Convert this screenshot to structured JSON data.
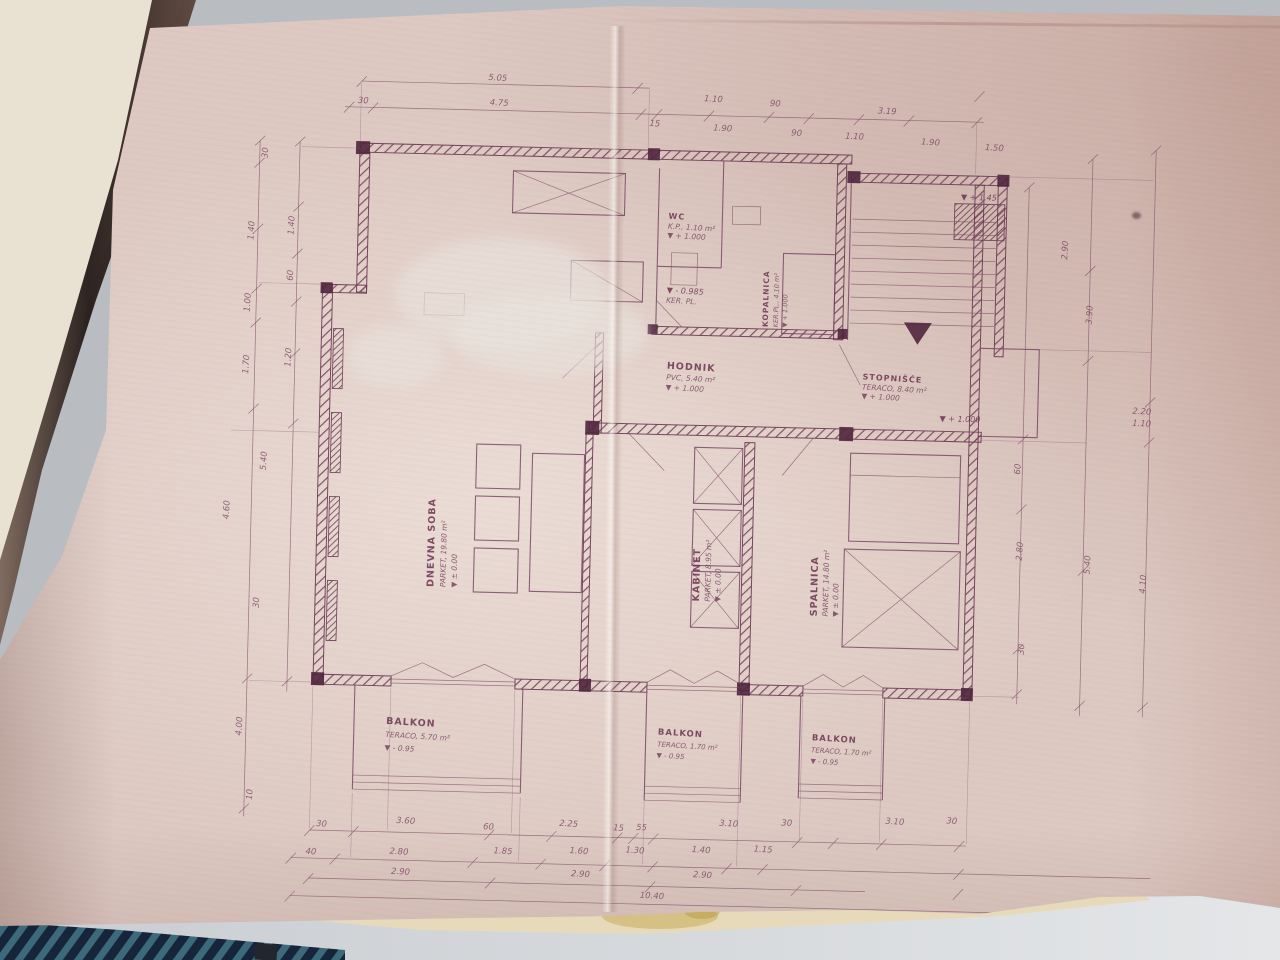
{
  "palette": {
    "paper_pink": "#ddc9c2",
    "ink_maroon": "#6b3350",
    "cover_brown": "#2e211f",
    "fabric_navy": "#1d2f42",
    "table_grey": "#d4d7da",
    "under_sheet_cream": "#e7dabb",
    "stain_yellow": "#c9b05e"
  },
  "plan": {
    "rooms": [
      {
        "name": "DNEVNA SOBA",
        "finish": "PARKET, 19.80 m²",
        "level": "▼ ± 0.00"
      },
      {
        "name": "KABINET",
        "finish": "PARKET, 8.95 m²",
        "level": "▼ ± 0.00"
      },
      {
        "name": "SPALNICA",
        "finish": "PARKET, 14.80 m²",
        "level": "▼ ± 0.00"
      },
      {
        "name": "HODNIK",
        "finish": "PVC, 5.40 m²",
        "level": "▼ + 1.000"
      },
      {
        "name": "STOPNIŠĆE",
        "finish": "TERACO, 8.40 m²",
        "level": "▼ + 1.000"
      },
      {
        "name": "WC",
        "finish": "K.P., 1.10 m²",
        "level": "▼ + 1.000"
      },
      {
        "name": "KOPALNICA",
        "finish": "KER.PL., 4.10 m²",
        "level": "▼ + 1.000"
      },
      {
        "name": "BALKON",
        "finish": "TERACO, 5.70 m²",
        "level": "▼ - 0.95"
      },
      {
        "name": "BALKON",
        "finish": "TERACO, 1.70 m²",
        "level": "▼ - 0.95"
      },
      {
        "name": "BALKON",
        "finish": "TERACO, 1.70 m²",
        "level": "▼ - 0.95"
      }
    ],
    "levels": {
      "stair_upper": "▼ + 1.45",
      "stair_mid": "▼ + 1.000",
      "wc_lower": "▼ - 0.985",
      "wc_lower_finish": "KER. PL."
    },
    "dimensions": [
      {
        "t": "5.05",
        "x": 488,
        "y": 84
      },
      {
        "t": "30",
        "x": 354,
        "y": 110
      },
      {
        "t": "4.75",
        "x": 490,
        "y": 109
      },
      {
        "t": "1.10",
        "x": 704,
        "y": 100,
        "r": 2
      },
      {
        "t": "90",
        "x": 766,
        "y": 103,
        "r": 2
      },
      {
        "t": "3.19",
        "x": 878,
        "y": 108,
        "r": 2
      },
      {
        "t": "15",
        "x": 646,
        "y": 126,
        "r": 2
      },
      {
        "t": "1.90",
        "x": 714,
        "y": 129,
        "r": 2
      },
      {
        "t": "90",
        "x": 788,
        "y": 132,
        "r": 2
      },
      {
        "t": "1.10",
        "x": 846,
        "y": 134,
        "r": 2
      },
      {
        "t": "1.90",
        "x": 922,
        "y": 138,
        "r": 2
      },
      {
        "t": "1.50",
        "x": 986,
        "y": 142,
        "r": 2
      },
      {
        "t": "30",
        "x": 260,
        "y": 162,
        "r": -88
      },
      {
        "t": "1.40",
        "x": 248,
        "y": 240,
        "r": -88
      },
      {
        "t": "1.40",
        "x": 288,
        "y": 234,
        "r": -88
      },
      {
        "t": "60",
        "x": 288,
        "y": 284,
        "r": -88
      },
      {
        "t": "1.00",
        "x": 246,
        "y": 312,
        "r": -88
      },
      {
        "t": "1.70",
        "x": 246,
        "y": 374,
        "r": -88
      },
      {
        "t": "1.20",
        "x": 288,
        "y": 366,
        "r": -88
      },
      {
        "t": "5.40",
        "x": 266,
        "y": 470,
        "r": -88
      },
      {
        "t": "4.60",
        "x": 230,
        "y": 520,
        "r": -88
      },
      {
        "t": "30",
        "x": 262,
        "y": 612,
        "r": -88
      },
      {
        "t": "4.00",
        "x": 248,
        "y": 736,
        "r": -88
      },
      {
        "t": "10",
        "x": 260,
        "y": 804,
        "r": -88
      },
      {
        "t": "2.90",
        "x": 1062,
        "y": 240,
        "r": -88
      },
      {
        "t": "3.90",
        "x": 1088,
        "y": 304,
        "r": -88
      },
      {
        "t": "60",
        "x": 1020,
        "y": 460,
        "r": -88
      },
      {
        "t": "2.80",
        "x": 1024,
        "y": 542,
        "r": -88
      },
      {
        "t": "30",
        "x": 1028,
        "y": 640,
        "r": -88
      },
      {
        "t": "5.40",
        "x": 1092,
        "y": 554,
        "r": -88
      },
      {
        "t": "2.20",
        "x": 1140,
        "y": 402,
        "r": 2
      },
      {
        "t": "1.10",
        "x": 1140,
        "y": 414,
        "r": 2
      },
      {
        "t": "4.10",
        "x": 1148,
        "y": 572,
        "r": -88
      },
      {
        "t": "30",
        "x": 330,
        "y": 834,
        "r": 2
      },
      {
        "t": "3.60",
        "x": 414,
        "y": 829,
        "r": 2
      },
      {
        "t": "60",
        "x": 497,
        "y": 833,
        "r": 2
      },
      {
        "t": "2.25",
        "x": 577,
        "y": 828,
        "r": 2
      },
      {
        "t": "15",
        "x": 627,
        "y": 831,
        "r": 2
      },
      {
        "t": "55",
        "x": 650,
        "y": 830,
        "r": 2
      },
      {
        "t": "3.10",
        "x": 737,
        "y": 824,
        "r": 2
      },
      {
        "t": "30",
        "x": 795,
        "y": 822,
        "r": 2
      },
      {
        "t": "3.10",
        "x": 903,
        "y": 818,
        "r": 2
      },
      {
        "t": "30",
        "x": 960,
        "y": 816,
        "r": 2
      },
      {
        "t": "40",
        "x": 320,
        "y": 862,
        "r": 2
      },
      {
        "t": "2.80",
        "x": 408,
        "y": 860,
        "r": 2
      },
      {
        "t": "1.85",
        "x": 512,
        "y": 857,
        "r": 2
      },
      {
        "t": "1.60",
        "x": 588,
        "y": 855,
        "r": 2
      },
      {
        "t": "1.30",
        "x": 644,
        "y": 853,
        "r": 2
      },
      {
        "t": "1.40",
        "x": 710,
        "y": 851,
        "r": 2
      },
      {
        "t": "1.15",
        "x": 772,
        "y": 849,
        "r": 2
      },
      {
        "t": "2.90",
        "x": 410,
        "y": 880,
        "r": 2
      },
      {
        "t": "2.90",
        "x": 590,
        "y": 878,
        "r": 2
      },
      {
        "t": "2.90",
        "x": 712,
        "y": 876,
        "r": 2
      },
      {
        "t": "10.40",
        "x": 662,
        "y": 898,
        "r": 2
      }
    ]
  }
}
